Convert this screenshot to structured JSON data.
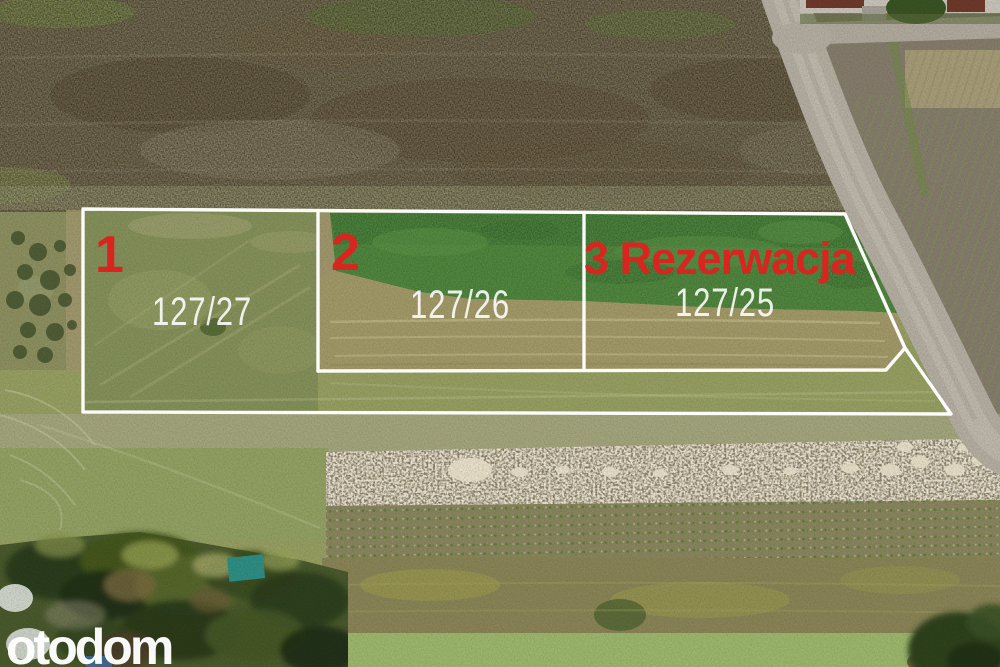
{
  "overlay": {
    "plots": [
      {
        "number": "1",
        "parcel": "127/27"
      },
      {
        "number": "2",
        "parcel": "127/26"
      },
      {
        "number": "3 Rezerwacja",
        "parcel": "127/25"
      }
    ],
    "label_color": "#d9251f",
    "parcel_text_color": "rgba(255,255,255,0.88)",
    "outline_color": "#ffffff"
  },
  "watermark": {
    "text": "otodom"
  }
}
